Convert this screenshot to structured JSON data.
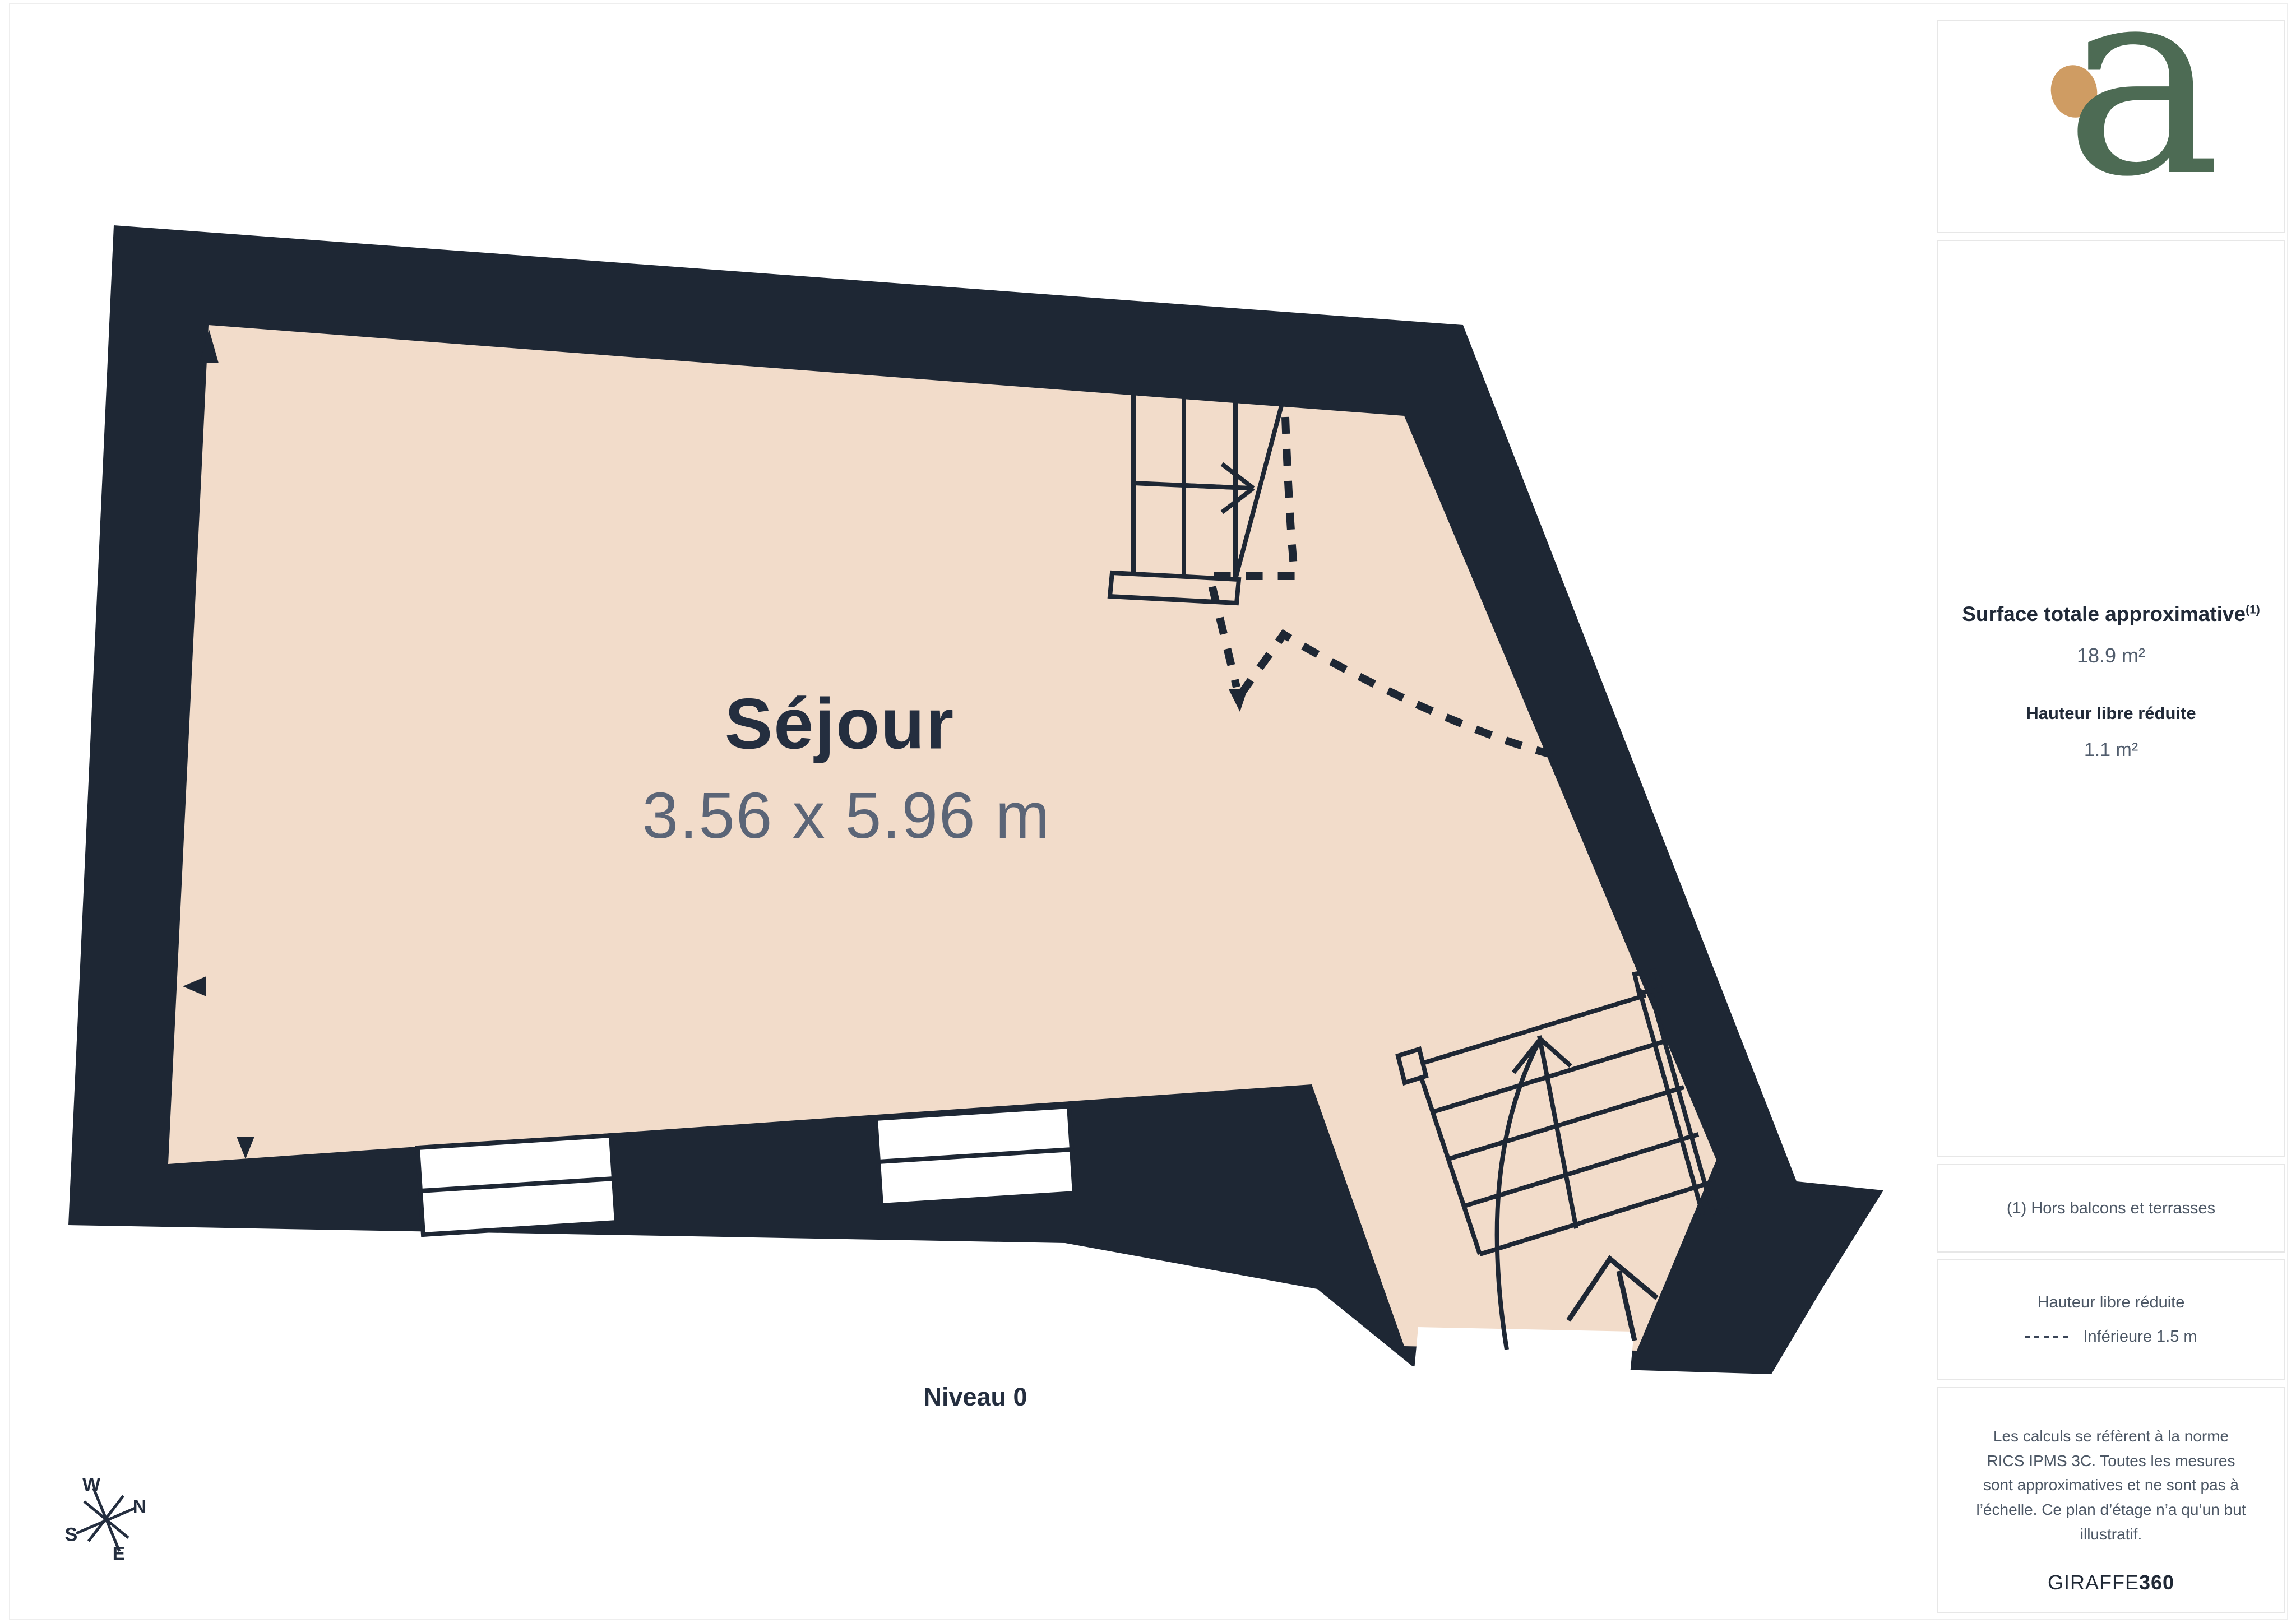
{
  "plan": {
    "room_label": "Séjour",
    "room_dimensions": "3.56 x 5.96 m",
    "level_label": "Niveau 0",
    "compass": {
      "west": "W",
      "north": "N",
      "south": "S",
      "east": "E"
    },
    "colors": {
      "wall": "#1e2734",
      "floor": "#f2dcca",
      "line": "#1e2734",
      "window": "#ffffff"
    }
  },
  "sidebar": {
    "logo_letter": "a",
    "logo_colors": {
      "letter_green": "#4d6b54",
      "dot_tan": "#cf9c63"
    },
    "surface_title": "Surface totale approximative",
    "surface_title_sup": "(1)",
    "surface_value": "18.9 m²",
    "height_title": "Hauteur libre réduite",
    "height_value": "1.1 m²",
    "footnote": "(1) Hors balcons et terrasses",
    "legend_title": "Hauteur libre réduite",
    "legend_item": "Inférieure 1.5 m",
    "disclaimer": "Les calculs se réfèrent à la norme RICS IPMS 3C. Toutes les mesures sont approximatives et ne sont pas à l’échelle. Ce plan d’étage n’a qu’un but illustratif.",
    "brand_name": "GIRAFFE",
    "brand_suffix": "360"
  }
}
